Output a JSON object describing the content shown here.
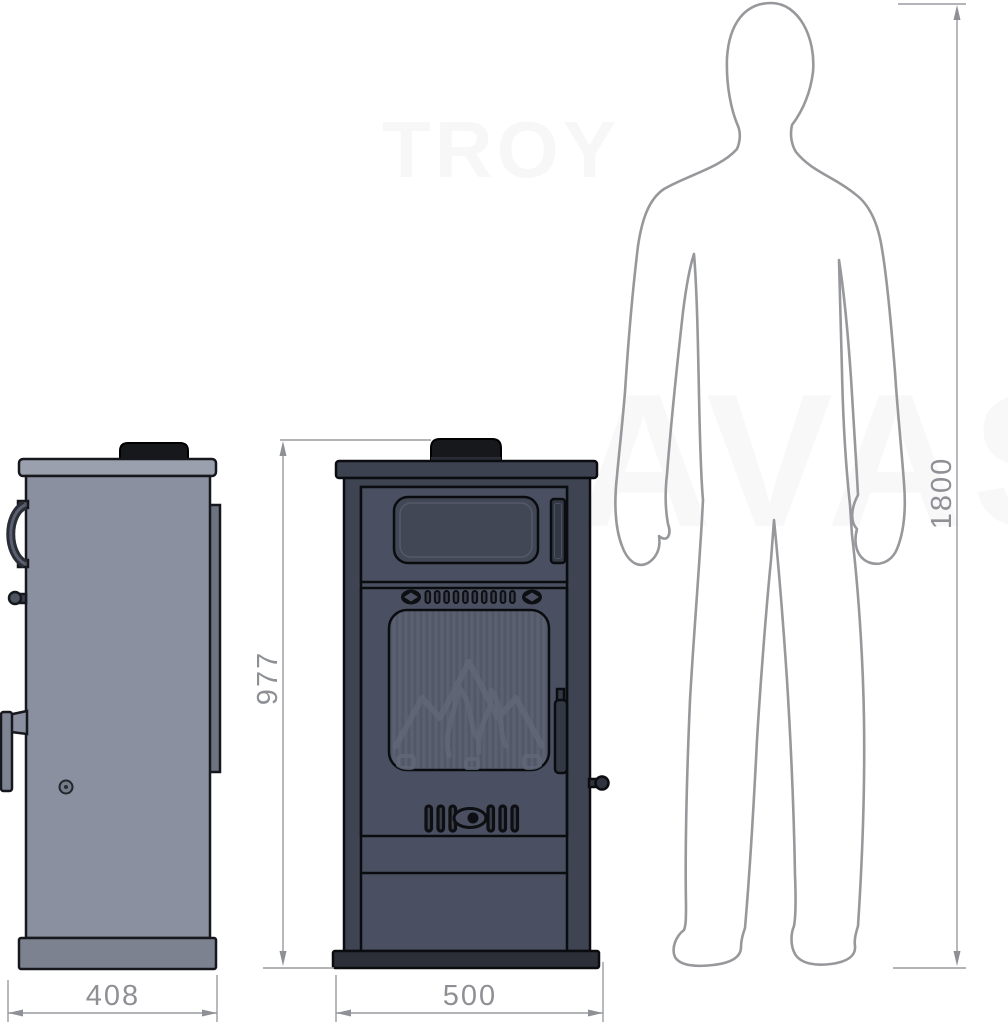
{
  "watermarks": {
    "top": "TROY",
    "center": "AVAS"
  },
  "dimensions": {
    "stove_height_mm": "977",
    "side_view_width_mm": "408",
    "front_view_width_mm": "500",
    "person_height_mm": "1800"
  },
  "colors": {
    "background": "#ffffff",
    "side_stove_body": "#8b90a0",
    "side_stove_top_plate": "#9aa0ad",
    "side_stove_base": "#7d8290",
    "front_stove_body": "#3f4452",
    "front_stove_door": "#4a5061",
    "front_stove_glass": "#575d6c",
    "flue_collar": "#17181c",
    "outline_dark": "#0b0c10",
    "dimension_gray": "#8f9096",
    "silhouette_gray": "#97989b"
  }
}
